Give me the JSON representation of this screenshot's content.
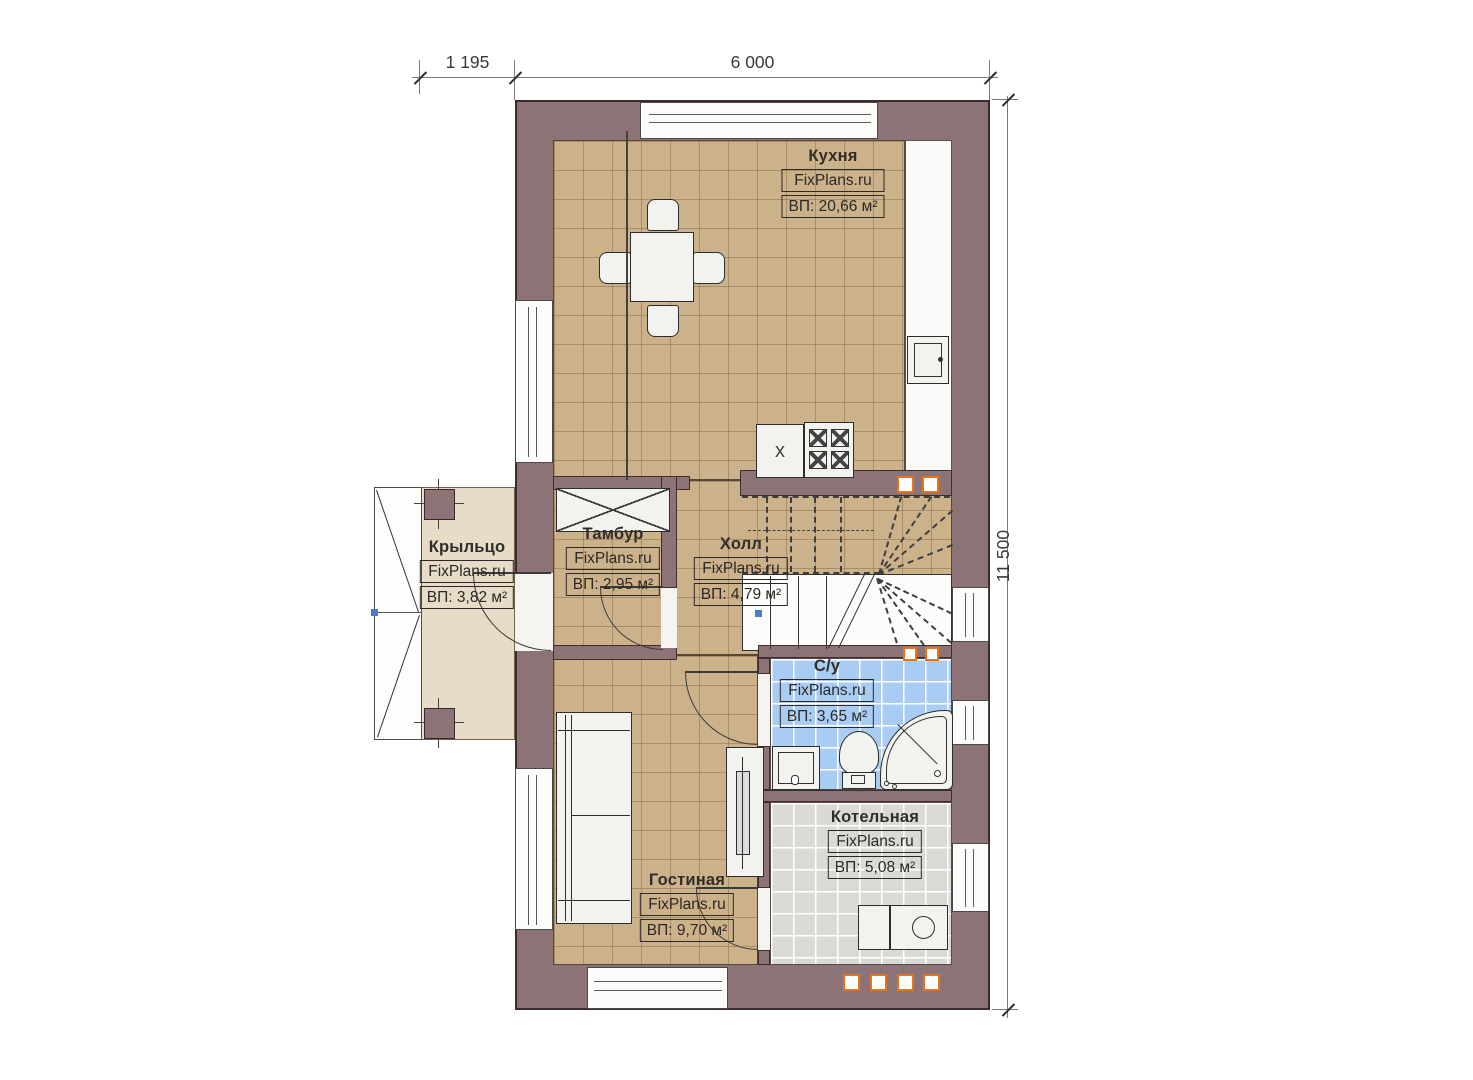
{
  "branding": {
    "watermark": "FixPlans.ru"
  },
  "dimensions": {
    "top_left": "1 195",
    "top_main": "6 000",
    "right": "11 500"
  },
  "rooms": {
    "kitchen": {
      "name": "Кухня",
      "brand": "FixPlans.ru",
      "area": "ВП: 20,66 м²"
    },
    "porch": {
      "name": "Крыльцо",
      "brand": "FixPlans.ru",
      "area": "ВП: 3,82 м²"
    },
    "tambour": {
      "name": "Тамбур",
      "brand": "FixPlans.ru",
      "area": "ВП: 2,95 м²"
    },
    "hall": {
      "name": "Холл",
      "brand": "FixPlans.ru",
      "area": "ВП: 4,79 м²"
    },
    "bathroom": {
      "name": "С/у",
      "brand": "FixPlans.ru",
      "area": "ВП: 3,65 м²"
    },
    "boiler": {
      "name": "Котельная",
      "brand": "FixPlans.ru",
      "area": "ВП: 5,08 м²"
    },
    "living": {
      "name": "Гостиная",
      "brand": "FixPlans.ru",
      "area": "ВП: 9,70 м²"
    }
  },
  "symbols": {
    "kitchen_unit_mark": "x"
  },
  "colors": {
    "wall": "#8c7476",
    "wall_outline": "#3c2b2d",
    "floor_tan": "#ccb28a",
    "floor_porch": "#e6dcc7",
    "floor_bathroom": "#a9cdf2",
    "floor_boiler": "#d9d9d5",
    "accent_orange": "#e8731d",
    "marker_blue": "#4d7cc9"
  }
}
